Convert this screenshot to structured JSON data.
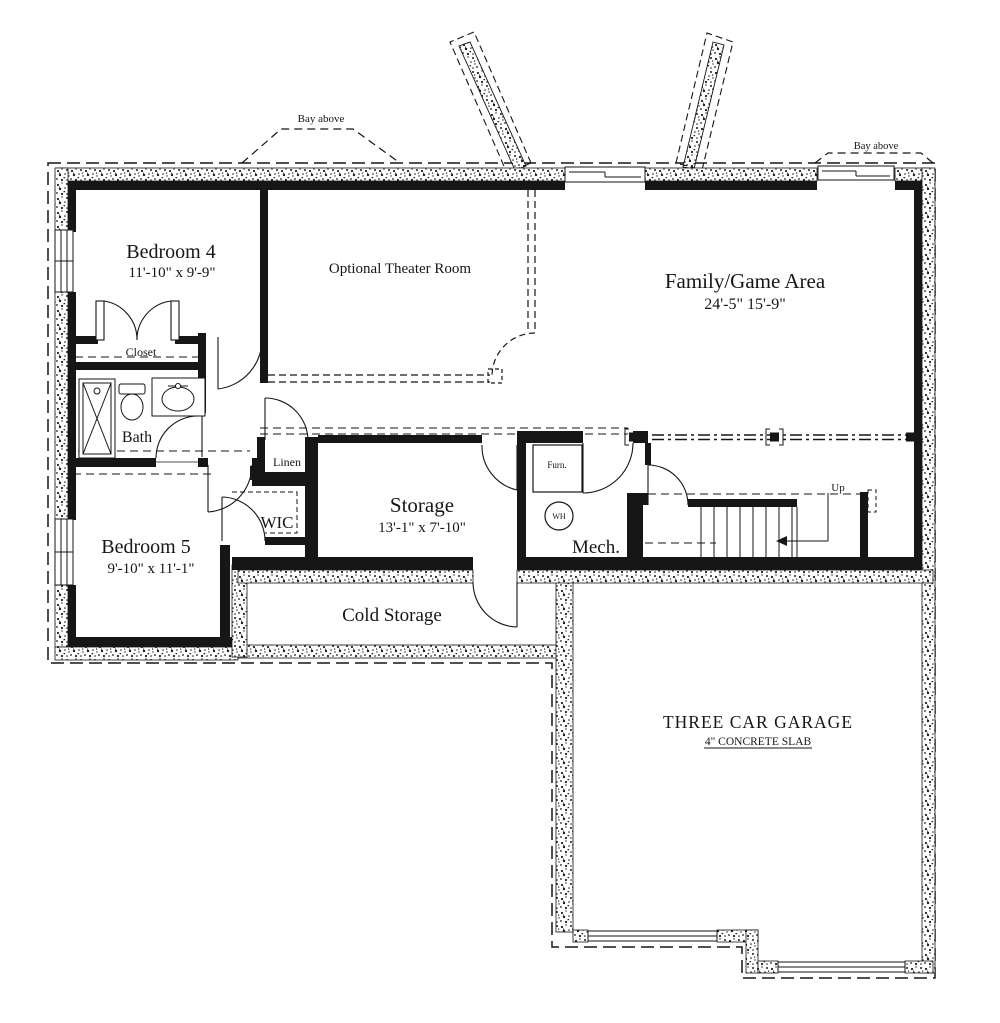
{
  "plan": {
    "title": "Basement floor plan",
    "rooms": {
      "bedroom4": {
        "name": "Bedroom 4",
        "dims": "11'-10\" x 9'-9\""
      },
      "theater": {
        "name": "Optional Theater Room"
      },
      "family": {
        "name": "Family/Game Area",
        "dims": "24'-5\" 15'-9\""
      },
      "bedroom5": {
        "name": "Bedroom 5",
        "dims": "9'-10\" x 11'-1\""
      },
      "storage": {
        "name": "Storage",
        "dims": "13'-1\" x 7'-10\""
      },
      "mech": {
        "name": "Mech."
      },
      "cold_storage": {
        "name": "Cold Storage"
      },
      "garage": {
        "name": "THREE CAR GARAGE",
        "note": "4\" CONCRETE SLAB"
      },
      "bath": {
        "name": "Bath"
      },
      "closet": {
        "name": "Closet"
      },
      "linen": {
        "name": "Linen"
      },
      "wic": {
        "name": "WIC"
      }
    },
    "annotations": {
      "bay_above_left": "Bay above",
      "bay_above_right": "Bay above",
      "up": "Up",
      "furnace": "Furn.",
      "water_heater": "WH"
    },
    "colors": {
      "ink": "#161616",
      "paper": "#ffffff"
    }
  }
}
